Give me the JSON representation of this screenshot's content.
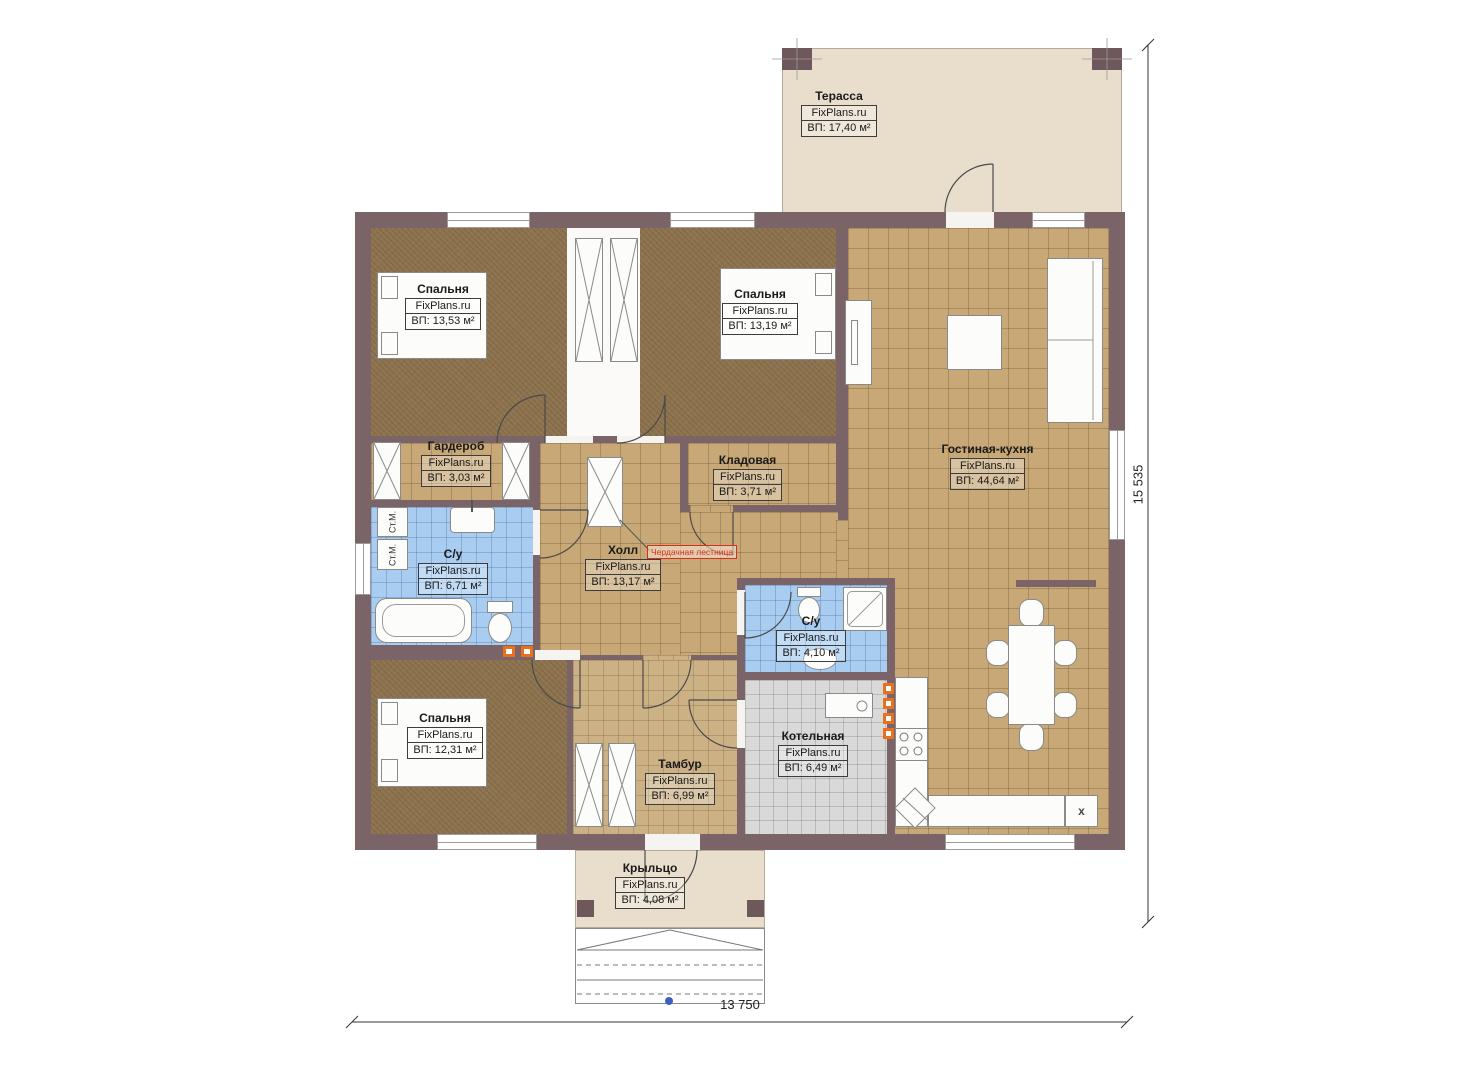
{
  "brand": "FixPlans.ru",
  "dimensions": {
    "height_label": "15 535",
    "width_label": "13 750"
  },
  "rooms": {
    "terrace": {
      "name": "Терасса",
      "brand": "FixPlans.ru",
      "area": "ВП: 17,40 м²"
    },
    "bedroom1": {
      "name": "Спальня",
      "brand": "FixPlans.ru",
      "area": "ВП: 13,53 м²"
    },
    "bedroom2": {
      "name": "Спальня",
      "brand": "FixPlans.ru",
      "area": "ВП: 13,19 м²"
    },
    "living_kitchen": {
      "name": "Гостиная-кухня",
      "brand": "FixPlans.ru",
      "area": "ВП: 44,64 м²"
    },
    "wardrobe": {
      "name": "Гардероб",
      "brand": "FixPlans.ru",
      "area": "ВП: 3,03 м²"
    },
    "storage": {
      "name": "Кладовая",
      "brand": "FixPlans.ru",
      "area": "ВП: 3,71 м²"
    },
    "bathroom1": {
      "name": "С/у",
      "brand": "FixPlans.ru",
      "area": "ВП: 6,71 м²"
    },
    "hall": {
      "name": "Холл",
      "brand": "FixPlans.ru",
      "area": "ВП: 13,17 м²"
    },
    "bathroom2": {
      "name": "С/у",
      "brand": "FixPlans.ru",
      "area": "ВП: 4,10 м²"
    },
    "bedroom3": {
      "name": "Спальня",
      "brand": "FixPlans.ru",
      "area": "ВП: 12,31 м²"
    },
    "vestibule": {
      "name": "Тамбур",
      "brand": "FixPlans.ru",
      "area": "ВП: 6,99 м²"
    },
    "boiler": {
      "name": "Котельная",
      "brand": "FixPlans.ru",
      "area": "ВП: 6,49 м²"
    },
    "porch": {
      "name": "Крыльцо",
      "brand": "FixPlans.ru",
      "area": "ВП: 4,08 м²"
    }
  },
  "annotations": {
    "attic_ladder": "Чердачная лестница",
    "washer_label": "Ст.М.",
    "fridge_label": "x"
  },
  "colors": {
    "wall": "#7a6468",
    "tile": "#c7a876",
    "carpet": "#8d734e",
    "bath_tile": "#a9cdf1",
    "boiler_tile": "#d9d9d9",
    "terrace": "#e9decb",
    "heater": "#e8701f",
    "annotation_red": "#cf331b"
  }
}
